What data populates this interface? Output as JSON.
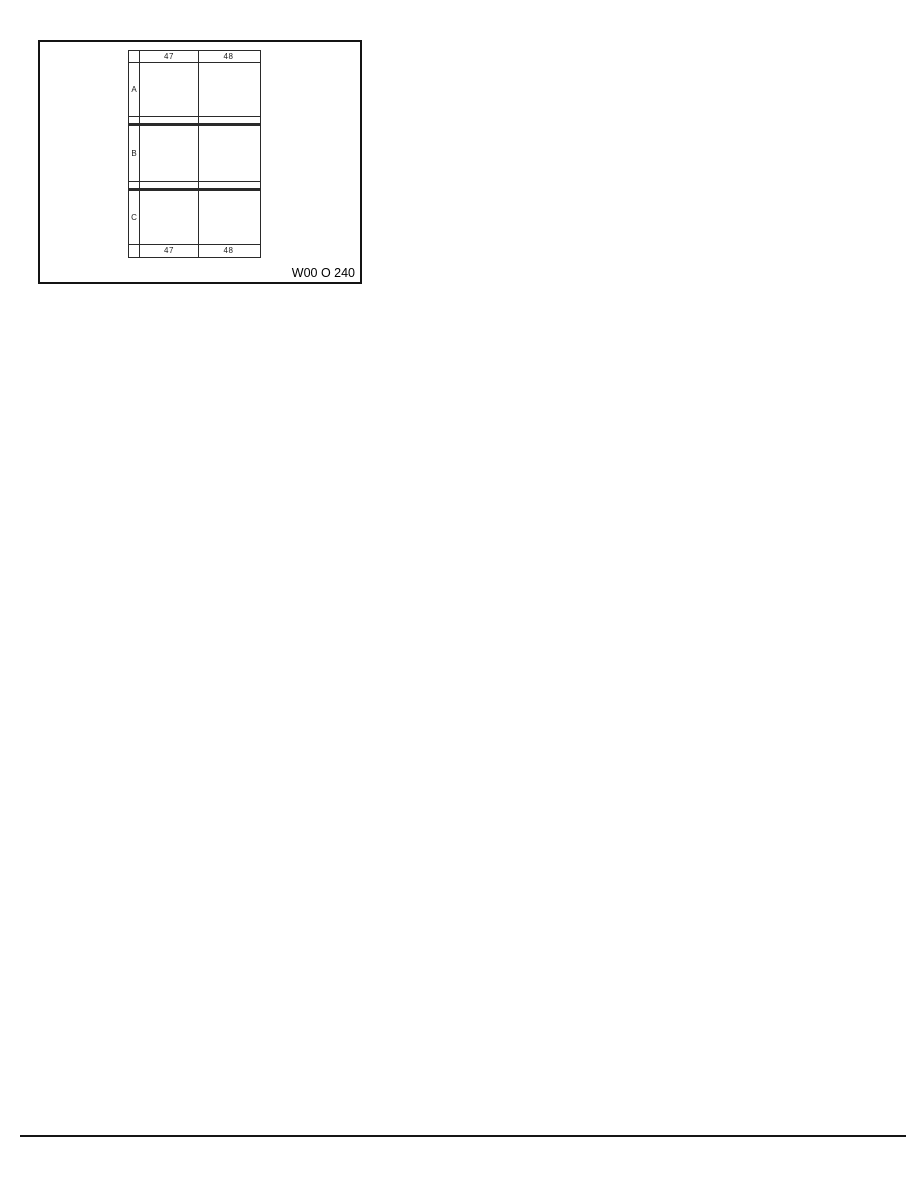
{
  "figure": {
    "caption": "W00 O 240",
    "grid": {
      "column_headers": [
        "47",
        "48"
      ],
      "column_footers": [
        "47",
        "48"
      ],
      "row_labels": [
        "A",
        "B",
        "C"
      ]
    }
  },
  "colors": {
    "line": "#141414",
    "background": "#ffffff"
  }
}
